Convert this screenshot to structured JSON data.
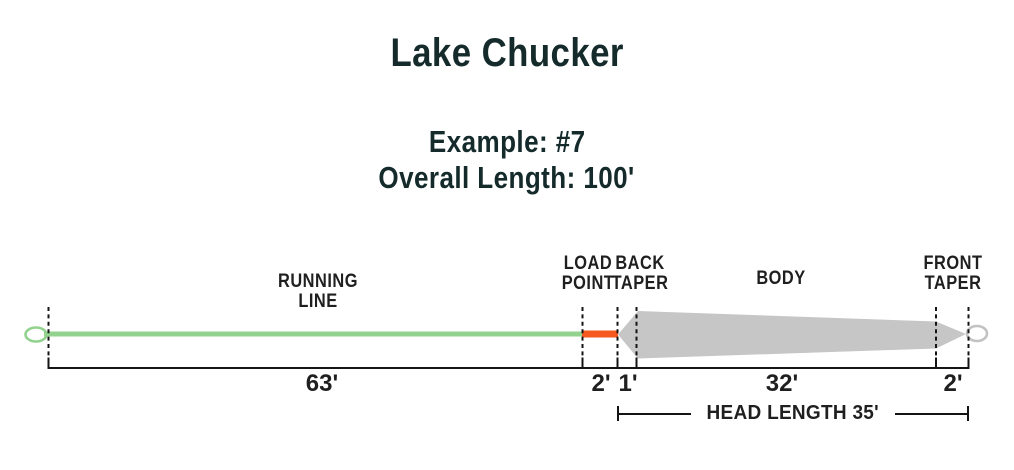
{
  "title": "Lake Chucker",
  "example_label": "Example: #7",
  "overall_length_label": "Overall Length: 100'",
  "head_length_label": "HEAD LENGTH 35'",
  "sections": {
    "running_line": {
      "line1": "RUNNING",
      "line2": "LINE",
      "length": "63'"
    },
    "load_point": {
      "line1": "LOAD",
      "line2": "POINT",
      "length": "2'"
    },
    "back_taper": {
      "line1": "BACK",
      "line2": "TAPER",
      "length": "1'"
    },
    "body": {
      "line1": "BODY",
      "length": "32'"
    },
    "front_taper": {
      "line1": "FRONT",
      "line2": "TAPER",
      "length": "2'"
    }
  },
  "colors": {
    "running_line_green": "#92d28e",
    "load_point_orange": "#f6591f",
    "head_gray": "#c6c6c6",
    "loop_gray": "#c2c2c2",
    "ink": "#141414",
    "heading": "#142a2b"
  }
}
